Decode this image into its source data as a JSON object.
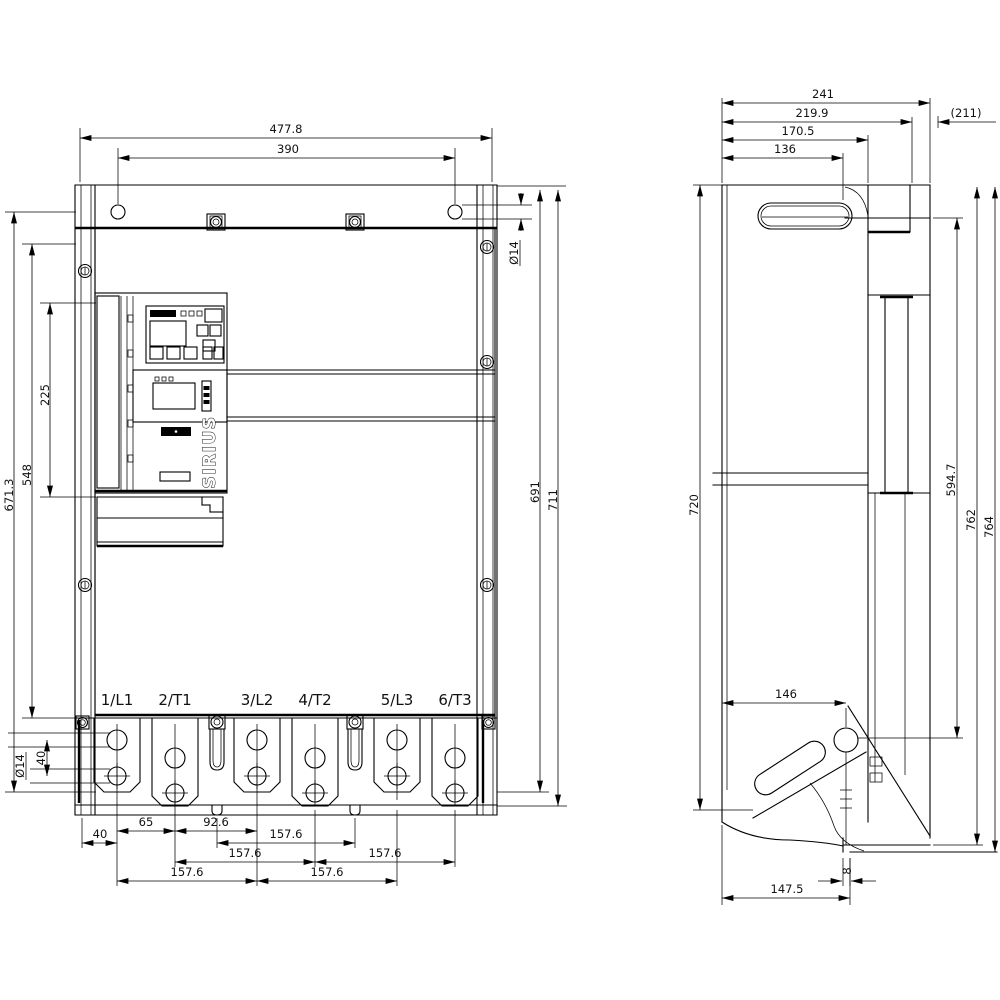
{
  "drawing": {
    "brand_label": "SIRIUS",
    "front": {
      "terminals": [
        "1/L1",
        "2/T1",
        "3/L2",
        "4/T2",
        "5/L3",
        "6/T3"
      ],
      "dims": {
        "overall_width": "477.8",
        "hole_spacing": "390",
        "height_671": "671.3",
        "height_548": "548",
        "height_225": "225",
        "height_691": "691",
        "height_711": "711",
        "dia_top": "Ø14",
        "dia_bottom": "Ø14",
        "offset_40v": "40",
        "offset_40h": "40",
        "pitch_65": "65",
        "pitch_92": "92.6",
        "pitch_157_a": "157.6",
        "pitch_157_b": "157.6",
        "pitch_157_c": "157.6",
        "pitch_157_d": "157.6",
        "pitch_157_e": "157.6"
      }
    },
    "side": {
      "dims": {
        "depth_241": "241",
        "depth_219": "219.9",
        "depth_211": "(211)",
        "depth_170": "170.5",
        "depth_136": "136",
        "height_720": "720",
        "height_594": "594.7",
        "height_762": "762",
        "height_764": "764",
        "width_146": "146",
        "foot_8": "8",
        "width_147": "147.5"
      }
    }
  }
}
